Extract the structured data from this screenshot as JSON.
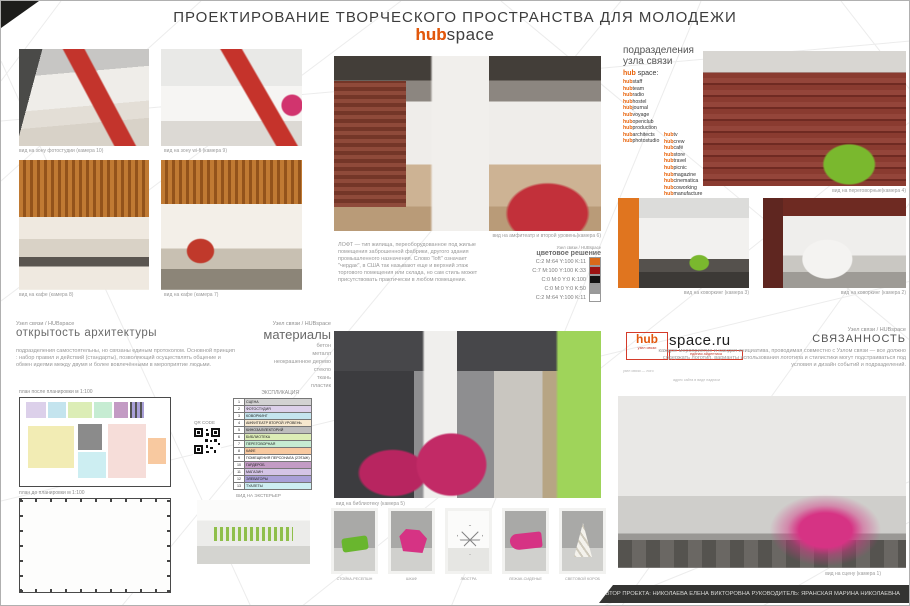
{
  "header": {
    "title": "ПРОЕКТИРОВАНИЕ  ТВОРЧЕСКОГО ПРОСТРАНСТВА ДЛЯ МОЛОДЕЖИ",
    "logo_hub": "hub",
    "logo_space": "space"
  },
  "captions": {
    "photostudio": "вид на зону фотостудии (камера 10)",
    "wifi": "вид на зону wi-fi (камера 9)",
    "cafe8": "вид на кафе (камера 8)",
    "cafe7": "вид на кафе (камера 7)",
    "amphitheater": "вид на амфитеатр и второй уровень(камера 6)",
    "meeting": "вид на переговорные(камера 4)",
    "coworking3": "вид на коворкинг (камера 3)",
    "coworking2": "вид на коворкинг (камера 2)",
    "library": "вид на библиотеку (камера 5)",
    "stage": "вид на сцену (камера 1)"
  },
  "divisions": {
    "heading1": "подразделения",
    "heading2": "узла связи",
    "brand_prefix": "hub",
    "brand_rest": " space:",
    "item_prefix": "hub",
    "col1": [
      "staff",
      "team",
      "radio",
      "hostel",
      "journal",
      "voyage",
      "openclub",
      "production",
      "architects",
      "photostudio"
    ],
    "col2": [
      "tv",
      "crew",
      "café",
      "store",
      "travel",
      "picnic",
      "magazine",
      "cinematica",
      "coworking",
      "manufacture"
    ]
  },
  "loft": {
    "body": "ЛОФТ — тип жилища, переоборудованное под жилые помещения заброшенной фабрики, другого здания промышленного назначения. Слово \"loft\" означает \"чердак\", в США так называют еще и верхний этаж торгового помещения или склада, но сам стиль может присутствовать практически в любом помещении."
  },
  "palette": {
    "heading_small": "Узел связи / HUBspace",
    "heading": "цветовое решение",
    "rows": [
      {
        "label": "C:2  M:64  Y:100 K:11",
        "color": "#d96a1a"
      },
      {
        "label": "C:7  M:100  Y:100 K:33",
        "color": "#9c1313"
      },
      {
        "label": "C:0  M:0  Y:0 K:100",
        "color": "#141414"
      },
      {
        "label": "C:0  M:0  Y:0 K:50",
        "color": "#9b9b9b"
      },
      {
        "label": "C:2  M:64  Y:100 K:11",
        "color": "#ffffff"
      }
    ]
  },
  "openness": {
    "heading_small": "Узел связи / HUBspace",
    "heading": "открытость архитектуры",
    "body": "подразделения самостоятельны, но связаны единым протоколом. Основной принцип : набор правил и действий (стандарты), позволяющий осуществлять общение  и обмен идеями между двумя и более вовлечёнными в мероприятие людьми."
  },
  "materials": {
    "heading_small": "Узел связи / HUBspace",
    "heading": "материалы",
    "items": [
      "бетон",
      "металл",
      "неокрашенное дерево",
      "стекло",
      "ткань",
      "пластик"
    ]
  },
  "plans": {
    "after_label": "план после планировки м 1:100",
    "before_label": "план до планировки м 1:100",
    "qr_label": "QR CODE",
    "legend_title": "ЭКСПЛИКАЦИЯ",
    "legend": [
      {
        "num": "1",
        "name": "СЦЕНА",
        "color": "#d2d2d2"
      },
      {
        "num": "2",
        "name": "ФОТОСТУДИЯ",
        "color": "#dcd0ea"
      },
      {
        "num": "3",
        "name": "КОВОРКИНГ",
        "color": "#c4e4ee"
      },
      {
        "num": "4",
        "name": "АМФИТЕАТР ВТОРОЙ УРОВЕНЬ",
        "color": "#f6e8cf"
      },
      {
        "num": "5",
        "name": "КИНОЗАЛ/ЛЕКТОРИЙ",
        "color": "#bdbdbd"
      },
      {
        "num": "6",
        "name": "БИБЛИОТЕКА",
        "color": "#dcedb6"
      },
      {
        "num": "7",
        "name": "ПЕРЕГОВОРНАЯ",
        "color": "#c6ecd2"
      },
      {
        "num": "8",
        "name": "КАФЕ",
        "color": "#f8c9a0"
      },
      {
        "num": "9",
        "name": "ПОМЕЩЕНИЯ ПЕРСОНАЛА (2ЭТАЖ)",
        "color": "#ffffff"
      },
      {
        "num": "10",
        "name": "ГАРДЕРОБ",
        "color": "#c39bc4"
      },
      {
        "num": "11",
        "name": "МАГАЗИН",
        "color": "#d4c4e6"
      },
      {
        "num": "12",
        "name": "ЭЛЕВАТОРЫ",
        "color": "#a9a0d8"
      },
      {
        "num": "13",
        "name": "ТУАЛЕТЫ",
        "color": "#cdeef2"
      }
    ]
  },
  "exterior": {
    "label": "ВИД НА ЭКСТЕРЬЕР"
  },
  "furniture_captions": [
    "СТОЙКА-РЕСЕПШН",
    "ШКАФ",
    "ЛЮСТРА",
    "ЛЕЖАК-СИДЕНЬЕ",
    "СВЕТОВОЙ КОРОБ"
  ],
  "sitelogo": {
    "hub": "hub",
    "sub": "узел связи",
    "domain": "space.ru",
    "tagline": "единая айдентика",
    "note1": "узел связи — лого",
    "note2": "адрес сайта в виде надписи"
  },
  "connectivity": {
    "heading_small": "Узел связи / HUBspace",
    "heading": "СВЯЗАННОСТЬ",
    "body": "каждое мероприятие и каждая инициатива, проводимая совместно с Узлом связи — все должно содержать логотип, варианты использования логотипа и стилистики могут подстраиваться под условия и дизайн событий и подразделений."
  },
  "credits": "АВТОР ПРОЕКТА: НИКОЛАЕВА ЕЛЕНА ВИКТОРОВНА    РУКОВОДИТЕЛЬ: ЯРАНСКАЯ МАРИНА НИКОЛАЕВНА"
}
